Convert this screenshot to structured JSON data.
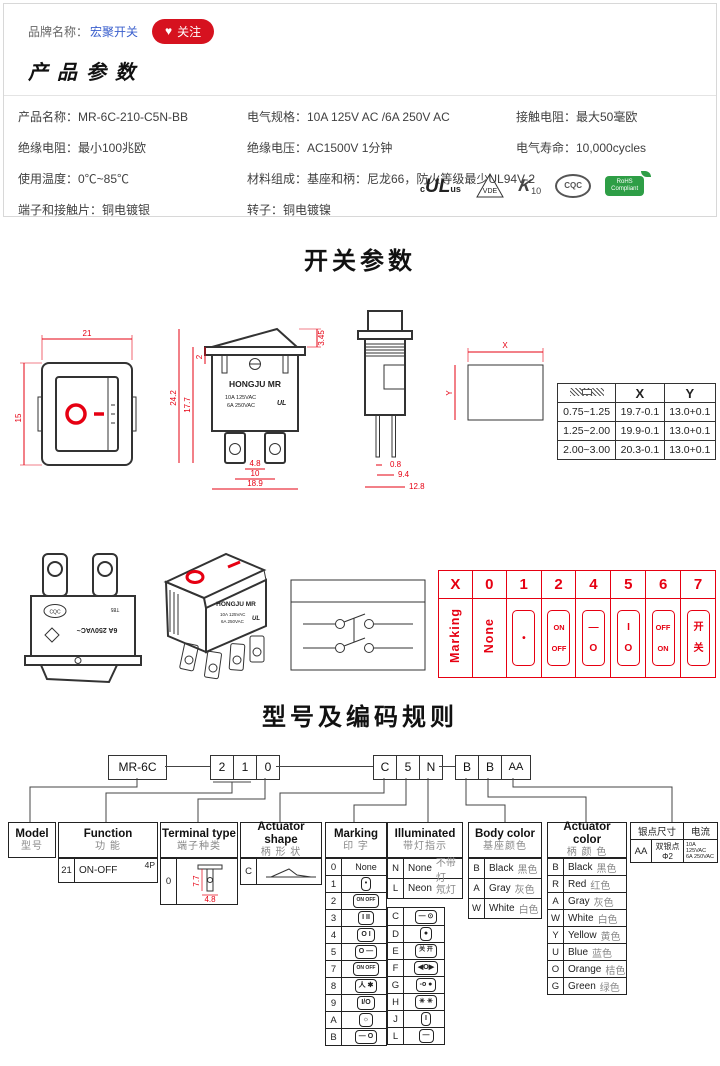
{
  "colors": {
    "accent_red": "#e60012",
    "brand_link": "#3a5fcd",
    "follow_bg": "#d6121f",
    "border_gray": "#d8d8d8"
  },
  "header": {
    "brand_label": "品牌名称：",
    "brand_name": "宏聚开关",
    "follow_label": "关注",
    "heart": "♥"
  },
  "product": {
    "title": "产品参数",
    "col1": [
      "产品名称：MR-6C-210-C5N-BB",
      "绝缘电阻：最小100兆欧",
      "使用温度：0℃~85℃",
      "端子和接触片：铜电镀银"
    ],
    "col2": [
      "电气规格：10A 125V AC /6A 250V AC",
      "绝缘电压：AC1500V 1分钟",
      "材料组成：基座和柄：尼龙66，防火等级最少UL94V-2",
      "转子：铜电镀镍"
    ],
    "col3": [
      "接触电阻：最大50毫欧",
      "电气寿命：10,000cycles"
    ],
    "certs": {
      "ul_c": "c",
      "ul_name": "UL",
      "ul_us": "us",
      "vde": "VDE",
      "enec_k": "K",
      "enec_num": "10",
      "cqc": "CQC",
      "rohs1": "RoHS",
      "rohs2": "Compliant"
    }
  },
  "switch_section": {
    "title": "开关参数",
    "top_view": {
      "w": "21",
      "h": "15"
    },
    "front_view": {
      "d_rocker": "3.45",
      "d_total": "24.2",
      "d_body": "17.7",
      "d_top": "2",
      "b_inner": "4.8",
      "b_center": "10",
      "b_outer": "18.9",
      "brand": "HONGJU MR",
      "rating1": "10A 125VAC",
      "rating2": "6A 250VAC",
      "ul": "UL"
    },
    "side_view": {
      "d_pin": "0.8",
      "d_center": "9.4",
      "d_outer": "12.8"
    },
    "cutout": {
      "x_label": "X",
      "y_label": "Y"
    },
    "cutout_table": {
      "col_x": "X",
      "col_y": "Y",
      "rows": [
        {
          "t": "0.75~1.25",
          "x": "19.7-0.1",
          "y": "13.0+0.1"
        },
        {
          "t": "1.25~2.00",
          "x": "19.9-0.1",
          "y": "13.0+0.1"
        },
        {
          "t": "2.00~3.00",
          "x": "20.3-0.1",
          "y": "13.0+0.1"
        }
      ]
    },
    "photo_back": {
      "rating": "6A 250VAC~",
      "cqc": "CQC",
      "t85": "T85"
    },
    "photo_front": {
      "brand": "HONGJU MR",
      "rating1": "10A 125VAC",
      "rating2": "6A 250VAC",
      "ul": "UL"
    },
    "marking_strip": {
      "codes": [
        "X",
        "0",
        "1",
        "2",
        "4",
        "5",
        "6",
        "7"
      ],
      "row_label": "Marking",
      "none_label": "None",
      "glyphs": [
        {
          "top": "•",
          "bottom": ""
        },
        {
          "top": "ON",
          "bottom": "OFF"
        },
        {
          "top": "—",
          "bottom": "O"
        },
        {
          "top": "I",
          "bottom": "O"
        },
        {
          "top": "OFF",
          "bottom": "ON"
        },
        {
          "top": "开",
          "bottom": "关"
        }
      ]
    }
  },
  "coding": {
    "title": "型号及编码规则",
    "code_model": "MR-6C",
    "code_func": [
      "2",
      "1",
      "0"
    ],
    "code_mid": [
      "C",
      "5",
      "N"
    ],
    "code_right": [
      "B",
      "B",
      "AA"
    ],
    "model_table": {
      "en": "Model",
      "cn": "型号"
    },
    "function_table": {
      "en": "Function",
      "cn": "功  能",
      "code": "21",
      "value": "ON-OFF",
      "poles": "4P"
    },
    "terminal_table": {
      "en": "Terminal type",
      "cn": "端子种类",
      "code": "0",
      "dim_v": "7.7",
      "dim_h": "4.8"
    },
    "shape_table": {
      "en": "Actuator shape",
      "cn": "柄 形 状",
      "code": "C"
    },
    "marking_table": {
      "en": "Marking",
      "cn": "印  字",
      "left": [
        {
          "code": "0",
          "glyph": "None"
        },
        {
          "code": "1",
          "glyph": "•"
        },
        {
          "code": "2",
          "glyph": "ON OFF"
        },
        {
          "code": "3",
          "glyph": "I II"
        },
        {
          "code": "4",
          "glyph": "O I"
        },
        {
          "code": "5",
          "glyph": "O —"
        },
        {
          "code": "7",
          "glyph": "ON OFF"
        },
        {
          "code": "8",
          "glyph": "人 ✱"
        },
        {
          "code": "9",
          "glyph": "I/O"
        },
        {
          "code": "A",
          "glyph": "☼"
        },
        {
          "code": "B",
          "glyph": "— O"
        }
      ],
      "right": [
        {
          "code": "C",
          "glyph": "— ⊙"
        },
        {
          "code": "D",
          "glyph": "●"
        },
        {
          "code": "E",
          "glyph": "关 开"
        },
        {
          "code": "F",
          "glyph": "◀O▶"
        },
        {
          "code": "G",
          "glyph": "-o ●"
        },
        {
          "code": "H",
          "glyph": "✳ ✳"
        },
        {
          "code": "J",
          "glyph": "I"
        },
        {
          "code": "L",
          "glyph": "—"
        }
      ]
    },
    "illuminated_table": {
      "en": "Illuminated",
      "cn": "带灯指示",
      "rows": [
        {
          "code": "N",
          "en": "None",
          "cn": "不带灯"
        },
        {
          "code": "L",
          "en": "Neon",
          "cn": "氖灯"
        }
      ]
    },
    "body_color_table": {
      "en": "Body color",
      "cn": "基座颜色",
      "rows": [
        {
          "code": "B",
          "en": "Black",
          "cn": "黑色"
        },
        {
          "code": "A",
          "en": "Gray",
          "cn": "灰色"
        },
        {
          "code": "W",
          "en": "White",
          "cn": "白色"
        }
      ]
    },
    "actuator_color_table": {
      "en": "Actuator color",
      "cn": "柄 颜 色",
      "rows": [
        {
          "code": "B",
          "en": "Black",
          "cn": "黑色"
        },
        {
          "code": "R",
          "en": "Red",
          "cn": "红色"
        },
        {
          "code": "A",
          "en": "Gray",
          "cn": "灰色"
        },
        {
          "code": "W",
          "en": "White",
          "cn": "白色"
        },
        {
          "code": "Y",
          "en": "Yellow",
          "cn": "黄色"
        },
        {
          "code": "U",
          "en": "Blue",
          "cn": "蓝色"
        },
        {
          "code": "O",
          "en": "Orange",
          "cn": "桔色"
        },
        {
          "code": "G",
          "en": "Green",
          "cn": "绿色"
        }
      ]
    },
    "silver_table": {
      "h_size": "银点尺寸",
      "h_current": "电流",
      "code": "AA",
      "desc": "双银点 Φ2",
      "current1": "10A 125VAC",
      "current2": "6A 250VAC"
    }
  }
}
